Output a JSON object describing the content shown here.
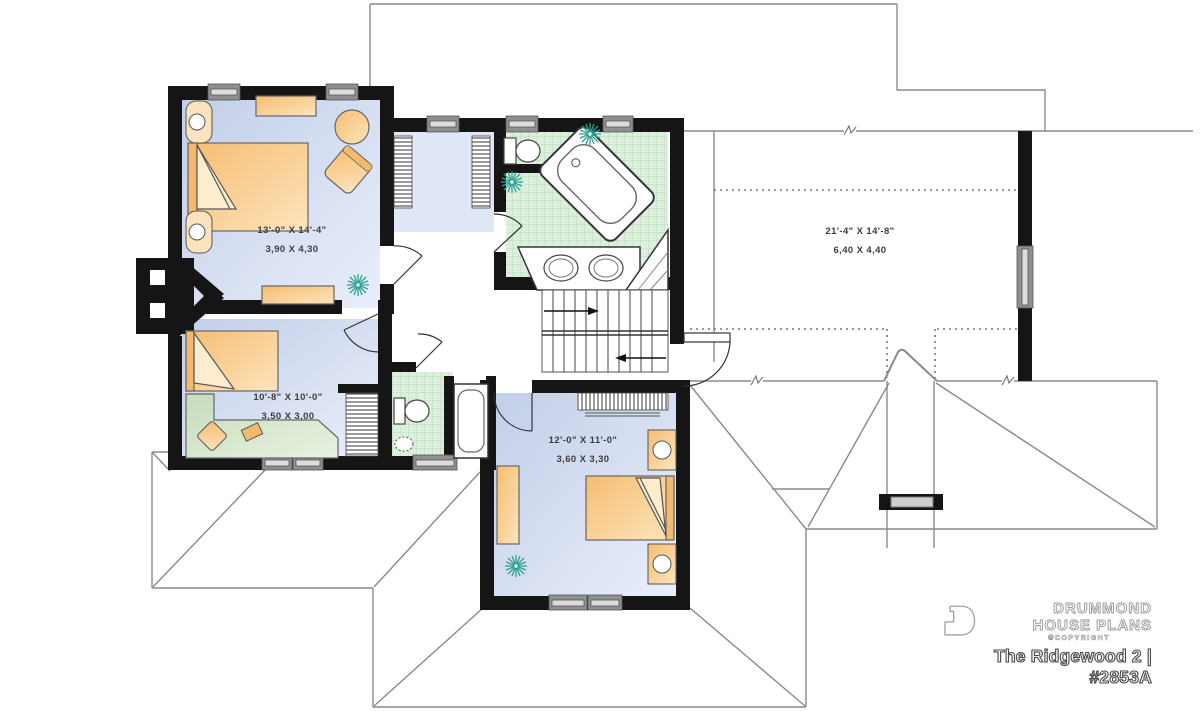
{
  "title": "The Ridgewood 2 | #2853A",
  "brand": {
    "name_line1": "DRUMMOND",
    "name_line2": "HOUSE PLANS",
    "copyright": "©COPYRIGHT",
    "logo_icon": "door-monogram-icon"
  },
  "rooms": {
    "master_bedroom": {
      "imperial": "13'-0\" X 14'-4\"",
      "metric": "3,90 X 4,30"
    },
    "bedroom_2": {
      "imperial": "10'-8\" X 10'-0\"",
      "metric": "3,50 X 3,00"
    },
    "bedroom_3": {
      "imperial": "12'-0\" X 11'-0\"",
      "metric": "3,60 X 3,30"
    },
    "bonus_space": {
      "imperial": "21'-4\" X 14'-8\"",
      "metric": "6,40 X 4,40"
    }
  },
  "colors": {
    "wall_black": "#151515",
    "floor_blue": "#c9d5ec",
    "closet_blue": "#dfe7f5",
    "tile_green": "#dcefdc",
    "furniture_orange": "#f6c27b",
    "desk_green": "#c8ddbd",
    "window_gray": "#8f8f8f",
    "roof_line_gray": "#8a8a8a",
    "plant_teal": "#2aa195"
  }
}
